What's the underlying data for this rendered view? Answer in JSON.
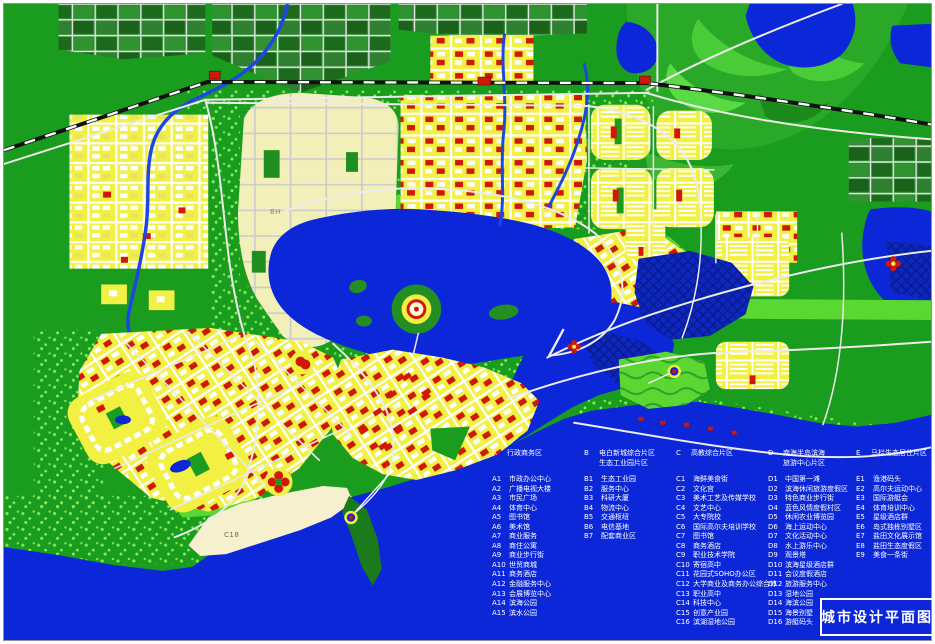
{
  "title": {
    "label": "城市设计平面图"
  },
  "map_labels": {
    "bh": "BH",
    "c18": "C18"
  },
  "legend": {
    "districts": [
      {
        "code": "A",
        "title_lines": [
          "行政商务区"
        ],
        "items": [
          [
            "A1",
            "市政办公中心"
          ],
          [
            "A2",
            "广播电视大楼"
          ],
          [
            "A3",
            "市民广场"
          ],
          [
            "A4",
            "体育中心"
          ],
          [
            "A5",
            "图书馆"
          ],
          [
            "A6",
            "美术馆"
          ],
          [
            "A7",
            "商业服务"
          ],
          [
            "A8",
            "商住公寓"
          ],
          [
            "A9",
            "商业步行街"
          ],
          [
            "A10",
            "世贸商城"
          ],
          [
            "A11",
            "商务酒店"
          ],
          [
            "A12",
            "金融服务中心"
          ],
          [
            "A13",
            "会展博览中心"
          ],
          [
            "A14",
            "滨海公园"
          ],
          [
            "A15",
            "滨水公园"
          ]
        ]
      },
      {
        "code": "B",
        "title_lines": [
          "电白新城综合片区",
          "生态工业园片区"
        ],
        "items": [
          [
            "B1",
            "生态工业园"
          ],
          [
            "B2",
            "服务中心"
          ],
          [
            "B3",
            "科研大厦"
          ],
          [
            "B4",
            "物流中心"
          ],
          [
            "B5",
            "交通枢纽"
          ],
          [
            "B6",
            "电信基地"
          ],
          [
            "B7",
            "配套商业区"
          ]
        ]
      },
      {
        "code": "C",
        "title_lines": [
          "高教综合片区"
        ],
        "items": [
          [
            "C1",
            "海鲜美食街"
          ],
          [
            "C2",
            "文化宫"
          ],
          [
            "C3",
            "美术工艺及传媒学校"
          ],
          [
            "C4",
            "文艺中心"
          ],
          [
            "C5",
            "大专院校"
          ],
          [
            "C6",
            "国际高尔夫培训学校"
          ],
          [
            "C7",
            "图书馆"
          ],
          [
            "C8",
            "商务酒店"
          ],
          [
            "C9",
            "职业技术学院"
          ],
          [
            "C10",
            "寄宿高中"
          ],
          [
            "C11",
            "花园式SOHO办公区"
          ],
          [
            "C12",
            "大学商业及商务办公综合体"
          ],
          [
            "C13",
            "职业高中"
          ],
          [
            "C14",
            "科技中心"
          ],
          [
            "C15",
            "创意产业园"
          ],
          [
            "C16",
            "滨湖湿地公园"
          ]
        ]
      },
      {
        "code": "D",
        "title_lines": [
          "南海半岛滨海",
          "旅游中心片区"
        ],
        "items": [
          [
            "D1",
            "中国第一滩"
          ],
          [
            "D2",
            "滨海休闲旅游度假区"
          ],
          [
            "D3",
            "特色商业步行街"
          ],
          [
            "D4",
            "蓝色风情度假村区"
          ],
          [
            "D5",
            "休闲农业博览园"
          ],
          [
            "D6",
            "海上运动中心"
          ],
          [
            "D7",
            "文化活动中心"
          ],
          [
            "D8",
            "水上游乐中心"
          ],
          [
            "D9",
            "观景塔"
          ],
          [
            "D10",
            "滨海星级酒店群"
          ],
          [
            "D11",
            "会议度假酒店"
          ],
          [
            "D12",
            "旅游服务中心"
          ],
          [
            "D13",
            "湿地公园"
          ],
          [
            "D14",
            "海滨公园"
          ],
          [
            "D15",
            "海景别墅"
          ],
          [
            "D16",
            "游艇码头"
          ]
        ]
      },
      {
        "code": "E",
        "title_lines": [
          "马栏生态居住片区"
        ],
        "items": [
          [
            "E1",
            "渔港码头"
          ],
          [
            "E2",
            "高尔夫运动中心"
          ],
          [
            "E3",
            "国际游艇会"
          ],
          [
            "E4",
            "体育培训中心"
          ],
          [
            "E5",
            "星级酒店群"
          ],
          [
            "E6",
            "岛式独栋别墅区"
          ],
          [
            "E7",
            "盐田文化展示馆"
          ],
          [
            "E8",
            "盐田生态度假区"
          ],
          [
            "E9",
            "美食一条街"
          ]
        ]
      }
    ]
  },
  "colors": {
    "base_green": "#1a9c1e",
    "water": "#0b27d8",
    "block_yellow": "#f1f043",
    "pale_zone": "#f3efb8",
    "building_red": "#d01708",
    "road_white": "#ececec",
    "railroad_black": "#101010",
    "lawn_green": "#5bd732",
    "farm_green": "#27862a",
    "beach_sand": "#f6f0cf",
    "legend_text": "#ffffff"
  }
}
